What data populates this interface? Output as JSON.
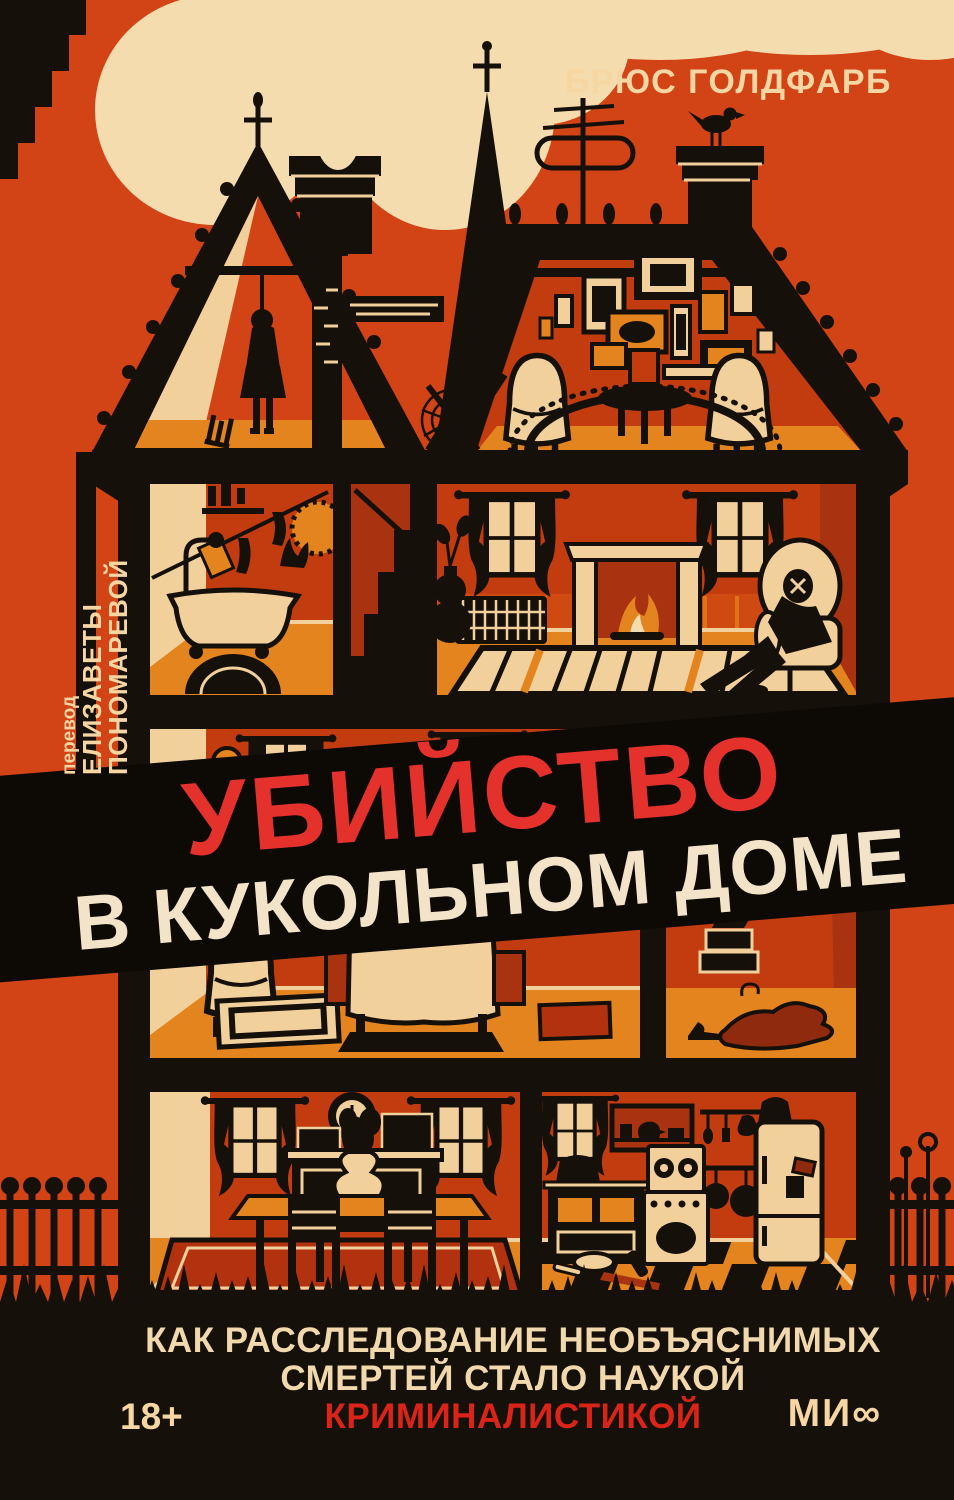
{
  "book_cover": {
    "author": "БРЮС ГОЛДФАРБ",
    "translator": {
      "label": "перевод",
      "name": "ЕЛИЗАВЕТЫ ПОНОМАРЕВОЙ"
    },
    "title": {
      "line1": "УБИЙСТВО",
      "line2": "В КУКОЛЬНОМ ДОМЕ"
    },
    "subtitle": {
      "line1": "КАК РАССЛЕДОВАНИЕ НЕОБЪЯСНИМЫХ",
      "line2": "СМЕРТЕЙ СТАЛО НАУКОЙ",
      "line3": "КРИМИНАЛИСТИКОЙ"
    },
    "age_rating": "18+",
    "publisher_logo": "МИ∞",
    "illustration": {
      "scene": "cutaway dollhouse cross-section with crime scenes",
      "icons": [
        "smoke-clouds",
        "turret-spire",
        "tv-antenna",
        "bird",
        "hanged-figure",
        "tipped-stool",
        "bathtub",
        "clothesline",
        "staircase",
        "fireplace",
        "slumped-body-in-armchair",
        "picture-gallery",
        "bed",
        "rug",
        "shoe-boxes",
        "dining-table",
        "wall-clock",
        "kitchen-stove",
        "refrigerator",
        "hanging-pans",
        "checkered-floor",
        "picket-fence",
        "grass"
      ]
    }
  },
  "palette": {
    "background": "#d24316",
    "ink_black": "#16100a",
    "cream": "#f2d09c",
    "smoke_cream": "#f4dcae",
    "floor_orange": "#e4841e",
    "wall_red": "#c23c10",
    "wall_dark_red": "#a93210",
    "banner_black": "#0d0a06",
    "title_red": "#e4312b",
    "subtitle_red": "#da2418"
  }
}
